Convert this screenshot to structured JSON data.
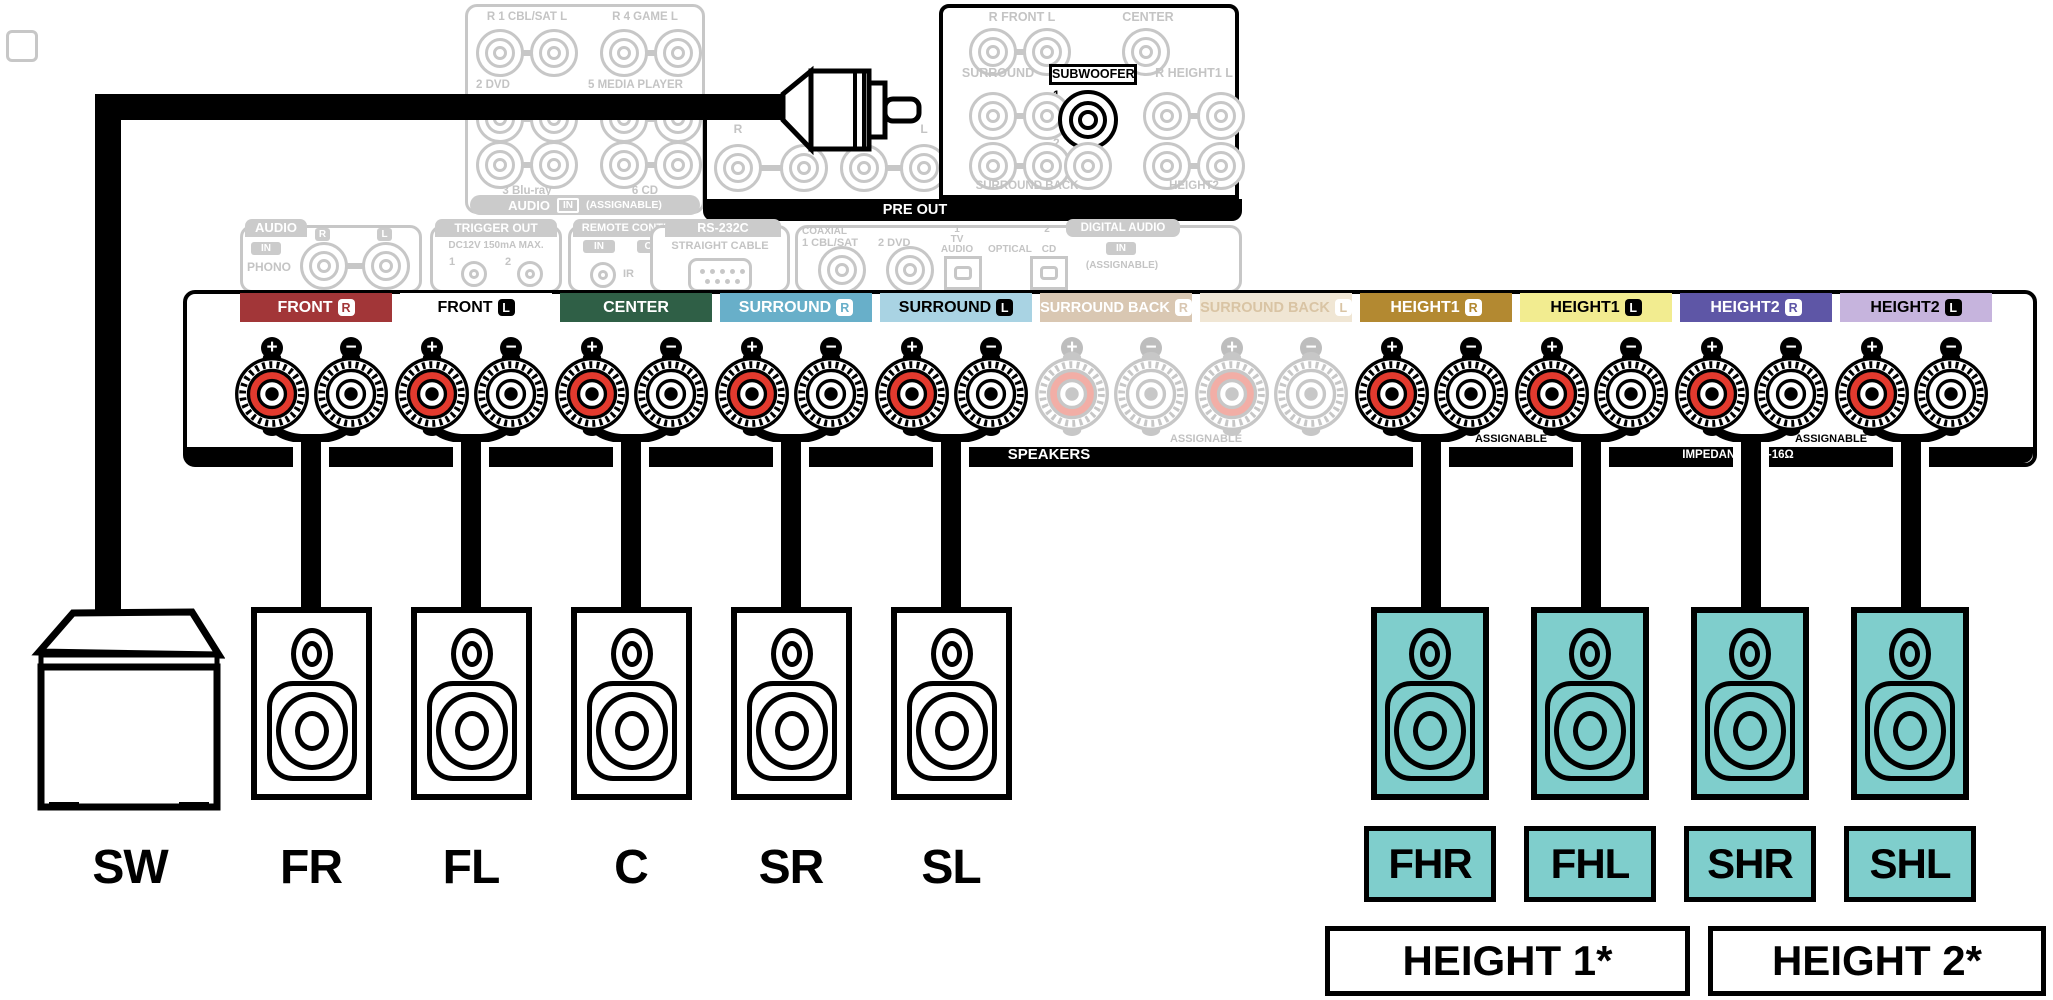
{
  "rear": {
    "analog": {
      "row1a": "R 1 CBL/SAT L",
      "row1b": "R 4 GAME L",
      "row2a": "2 DVD",
      "row2b": "5 MEDIA PLAYER",
      "row3a": "3 Blu-ray",
      "row3b": "6 CD",
      "bar_audio": "AUDIO",
      "bar_in": "IN",
      "bar_assignable": "(ASSIGNABLE)"
    },
    "preout": {
      "front": "R FRONT L",
      "center": "CENTER",
      "surround": "SURROUND",
      "subwoofer": "SUBWOOFER",
      "one": "1",
      "height1": "R HEIGHT1 L",
      "two": "2",
      "surround_back": "SURROUND BACK",
      "height2": "HEIGHT2",
      "bar": "PRE OUT"
    },
    "ext": {
      "r1": "R",
      "l1": "L",
      "r2": "R",
      "l2": "L"
    },
    "panels": {
      "audio": {
        "tab": "AUDIO",
        "in": "IN",
        "phono": "PHONO",
        "r": "R",
        "l": "L"
      },
      "trigger": {
        "tab": "TRIGGER OUT",
        "spec": "DC12V 150mA MAX.",
        "one": "1",
        "two": "2"
      },
      "remote": {
        "tab": "REMOTE CONTROL",
        "in": "IN",
        "out": "OUT",
        "ir": "IR"
      },
      "rs232c": {
        "tab": "RS-232C",
        "cable": "STRAIGHT CABLE"
      },
      "digital": {
        "coaxial": "COAXIAL",
        "cblsat": "1 CBL/SAT",
        "dvd": "2 DVD",
        "one": "1",
        "tv": "TV",
        "audio": "AUDIO",
        "optical": "OPTICAL",
        "two": "2",
        "cd": "CD",
        "tab": "DIGITAL AUDIO",
        "in": "IN",
        "assignable": "(ASSIGNABLE)"
      }
    }
  },
  "terminals": {
    "channels": [
      {
        "label": "FRONT",
        "badge": "R",
        "bg": "#A23638",
        "fg": "#FFFFFF",
        "active": true
      },
      {
        "label": "FRONT",
        "badge": "L",
        "bg": "#FFFFFF",
        "fg": "#000000",
        "active": true
      },
      {
        "label": "CENTER",
        "badge": "",
        "bg": "#2F5F46",
        "fg": "#FFFFFF",
        "active": true
      },
      {
        "label": "SURROUND",
        "badge": "R",
        "bg": "#68AFC9",
        "fg": "#FFFFFF",
        "active": true
      },
      {
        "label": "SURROUND",
        "badge": "L",
        "bg": "#A9D3E3",
        "fg": "#000000",
        "active": true
      },
      {
        "label": "SURROUND BACK",
        "badge": "R",
        "bg": "#D9C7B2",
        "fg": "#FFFFFF",
        "active": false
      },
      {
        "label": "SURROUND BACK",
        "badge": "L",
        "bg": "#F0E6D4",
        "fg": "#D9C4A4",
        "active": false
      },
      {
        "label": "HEIGHT1",
        "badge": "R",
        "bg": "#B38931",
        "fg": "#FFFFFF",
        "active": true
      },
      {
        "label": "HEIGHT1",
        "badge": "L",
        "bg": "#F2EC90",
        "fg": "#000000",
        "active": true
      },
      {
        "label": "HEIGHT2",
        "badge": "R",
        "bg": "#5E56A6",
        "fg": "#FFFFFF",
        "active": true
      },
      {
        "label": "HEIGHT2",
        "badge": "L",
        "bg": "#C6B4DD",
        "fg": "#000000",
        "active": true
      }
    ],
    "plus": "+",
    "minus": "−",
    "speakers_bar": "SPEAKERS",
    "assignable_ghost": "ASSIGNABLE",
    "assignable1": "ASSIGNABLE",
    "assignable2": "ASSIGNABLE",
    "impedance": "IMPEDANCE : 4-16Ω",
    "post_red": "#E23A2E",
    "post_white": "#FFFFFF",
    "post_ghost_red": "#F2AEA6"
  },
  "speakers": {
    "labels": {
      "sw": "SW",
      "fr": "FR",
      "fl": "FL",
      "c": "C",
      "sr": "SR",
      "sl": "SL"
    },
    "height_labels": {
      "fhr": "FHR",
      "fhl": "FHL",
      "shr": "SHR",
      "shl": "SHL"
    },
    "groups": {
      "height1": "HEIGHT 1*",
      "height2": "HEIGHT 2*"
    },
    "teal": "#7FCECC"
  }
}
